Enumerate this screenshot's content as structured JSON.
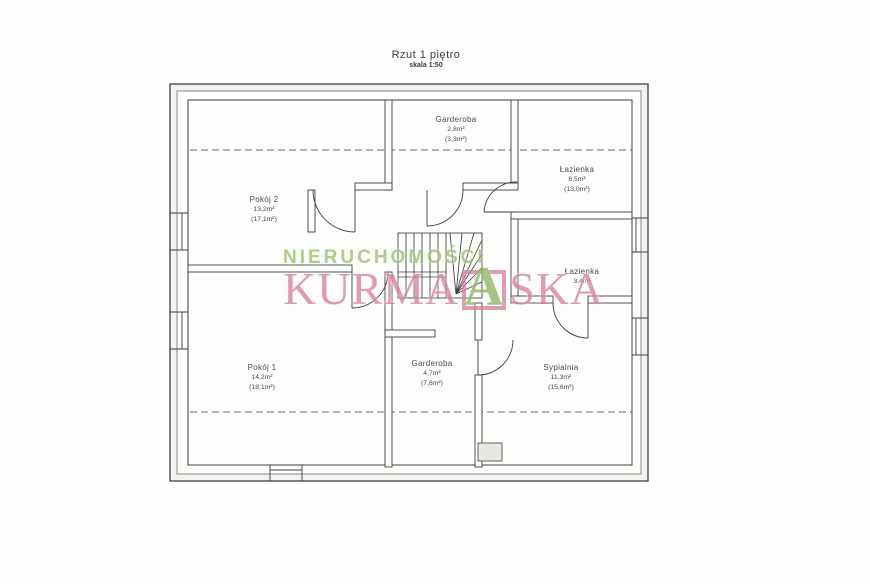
{
  "title": {
    "text": "Rzut 1 piętro",
    "scale": "skala 1:50"
  },
  "watermark": {
    "line1": "NIERUCHOMOŚCI",
    "brand_prefix": "KURMA",
    "logo_letter": "A",
    "brand_suffix": "SKA",
    "green_color": "#9cbd6f",
    "pink_color": "#d2839a"
  },
  "rooms": [
    {
      "name": "Garderoba",
      "area": "2,8m²",
      "gross": "(3,3m²)"
    },
    {
      "name": "Łazienka",
      "area": "8,5m²",
      "gross": "(13,0m²)"
    },
    {
      "name": "Pokój 2",
      "area": "13,2m²",
      "gross": "(17,1m²)"
    },
    {
      "name": "Łazienka",
      "area": "3,4m²",
      "gross": ""
    },
    {
      "name": "Pokój 1",
      "area": "14,2m²",
      "gross": "(18,1m²)"
    },
    {
      "name": "Garderoba",
      "area": "4,7m²",
      "gross": "(7,6m²)"
    },
    {
      "name": "Sypialnia",
      "area": "11,3m²",
      "gross": "(15,6m²)"
    }
  ]
}
